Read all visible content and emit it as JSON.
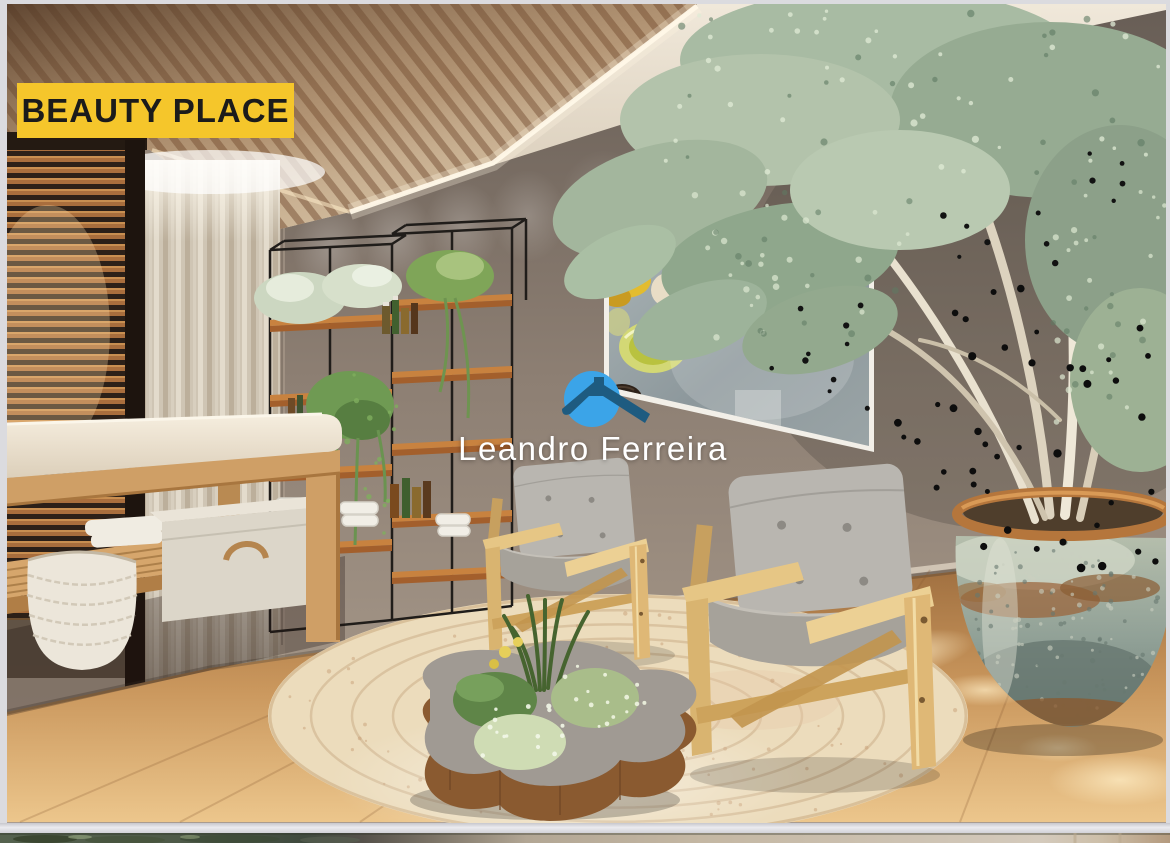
{
  "page": {
    "background_color": "#DBDBDF"
  },
  "photo": {
    "description": "3D render of a spa beauty room: wood-slat ceiling with cove lighting, venetian blinds, sheer curtain, wooden massage table with baskets and towels, black metal plant shelving with bottles, framed spa artwork, two oak armchairs with gray cushions, round braided jute rug, organic live-edge coffee table planted with greenery, and a large glazed urn with a eucalyptus tree",
    "badge": {
      "label": "BEAUTY PLACE",
      "background_color": "#F5C62B",
      "text_color": "#1B1B1B"
    },
    "watermark": {
      "text": "Leandro Ferreira",
      "text_color": "#FFFFFF",
      "logo": {
        "icon": "house-roof-logo",
        "circle_color": "#3BA4E8",
        "roof_color": "#1E5B80"
      }
    }
  },
  "gallery": {
    "next_photo_visible": true
  }
}
